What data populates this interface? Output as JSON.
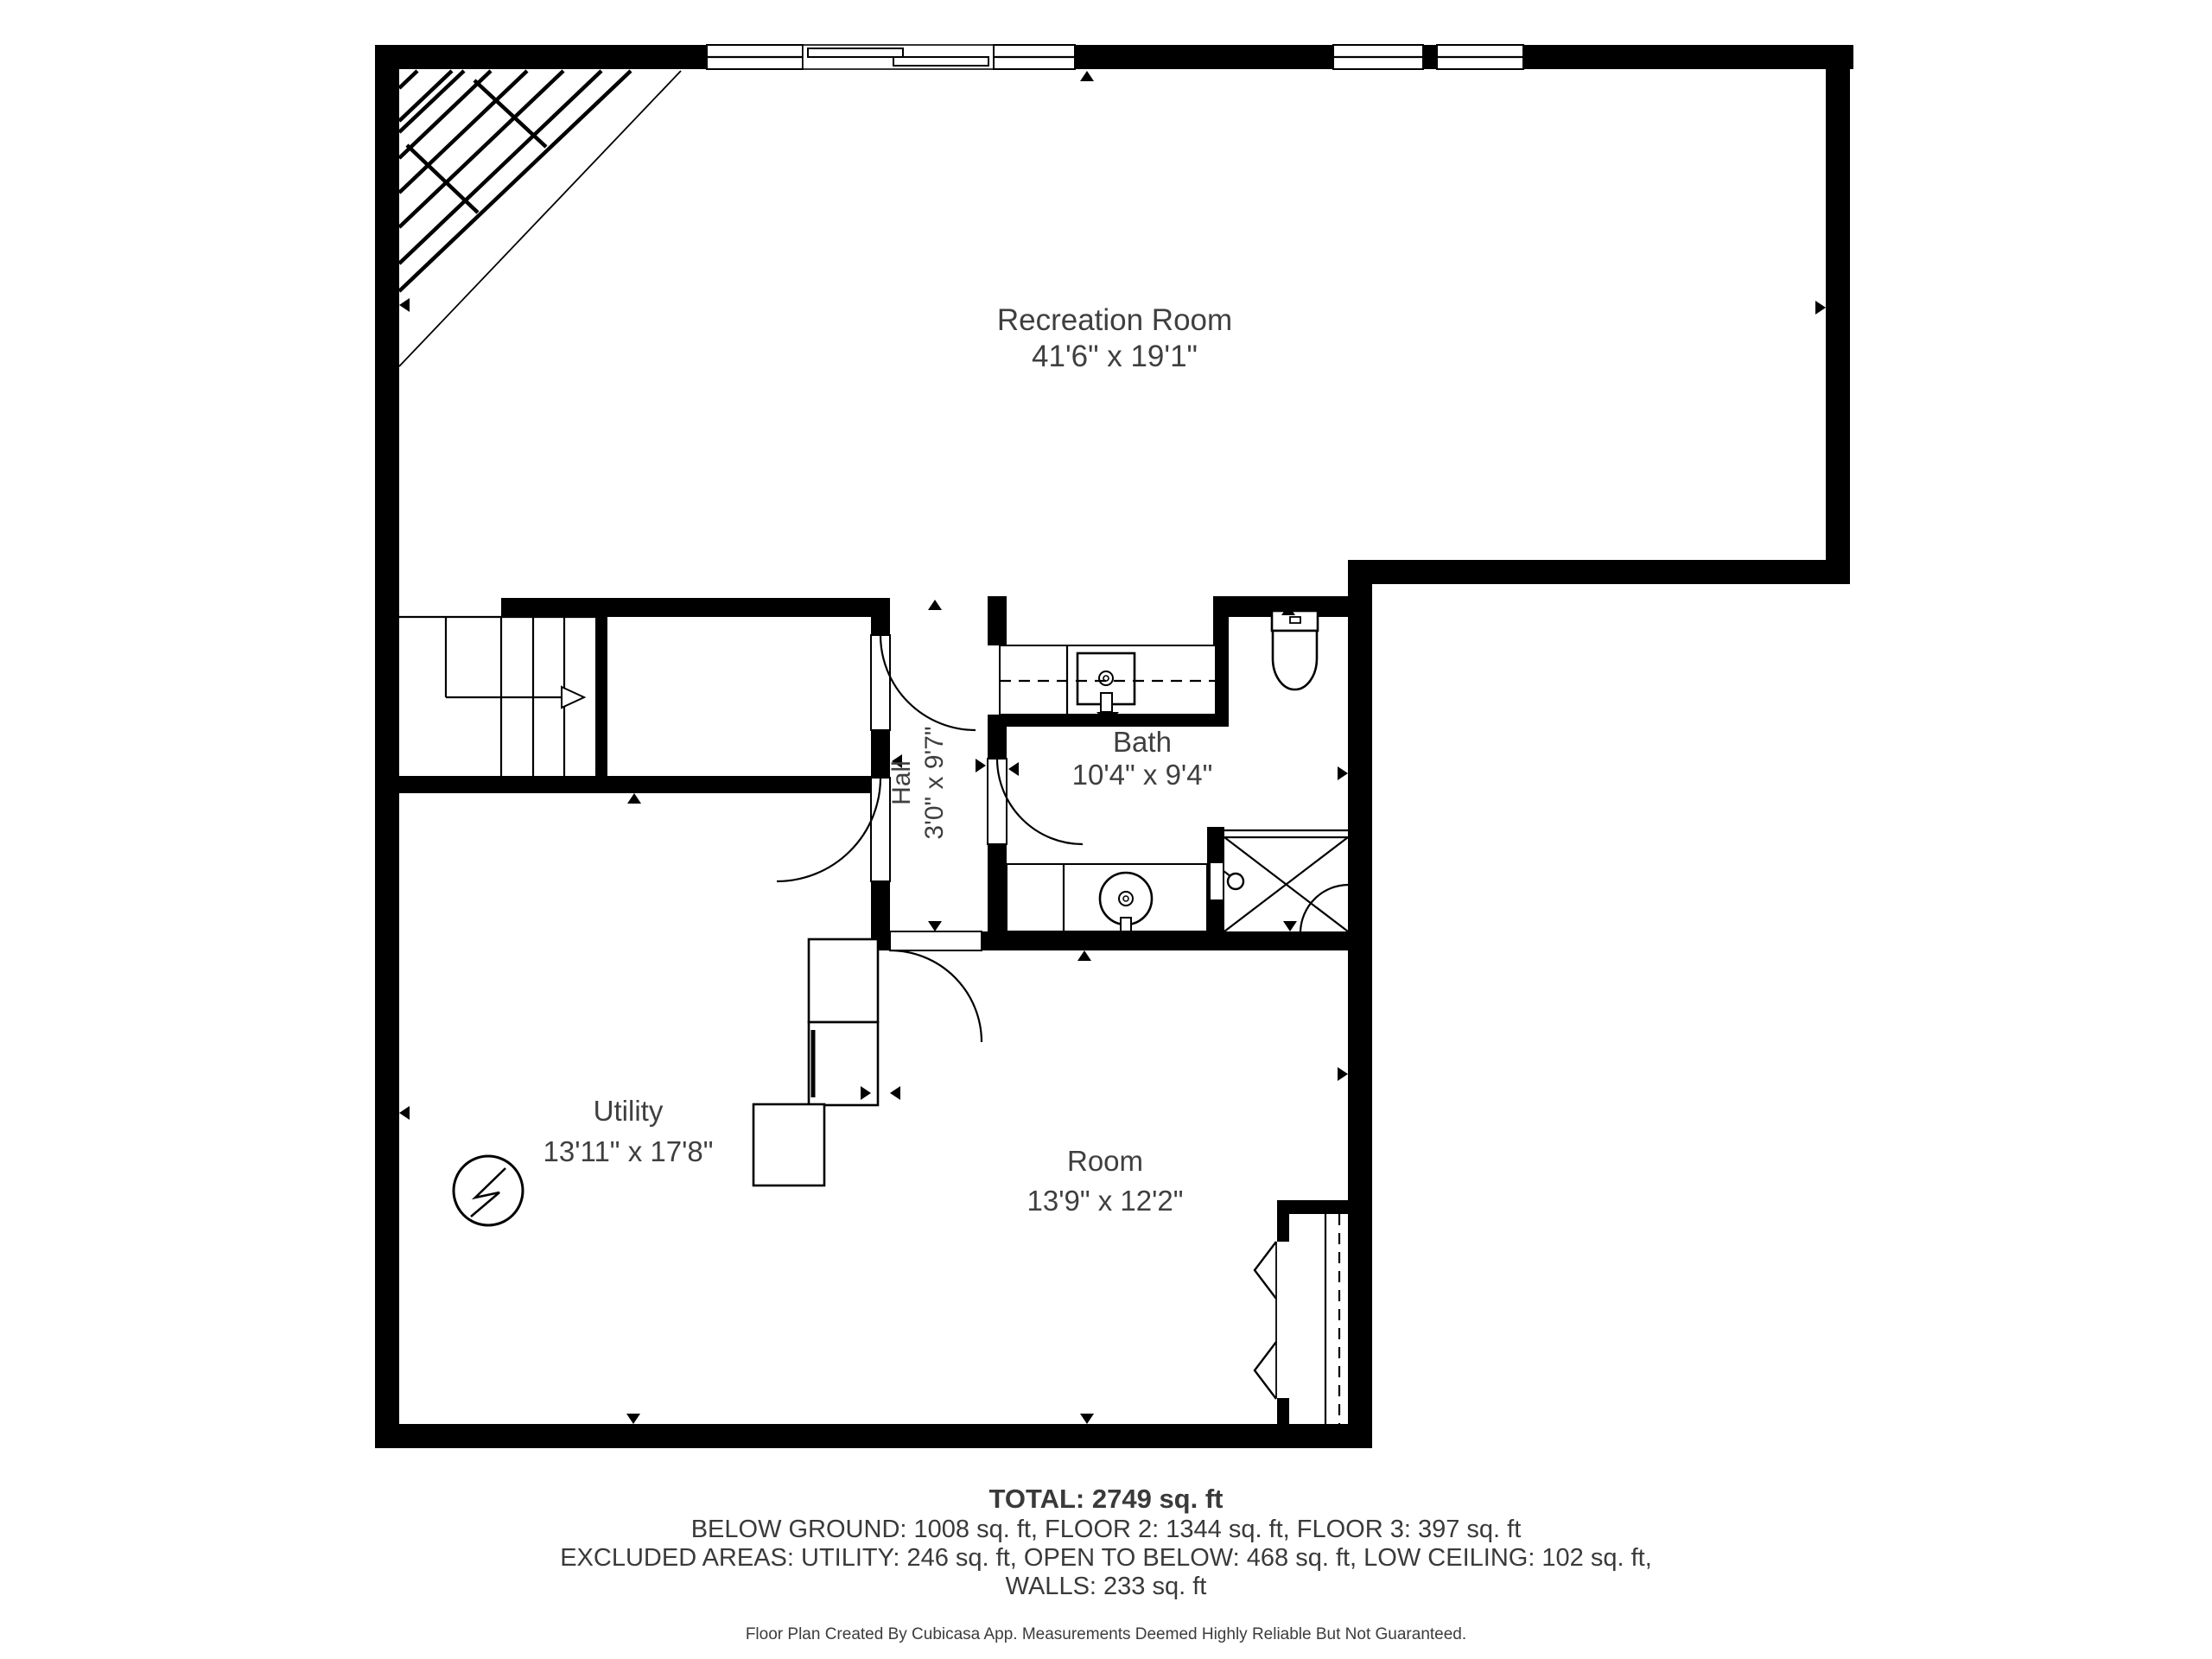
{
  "rooms": {
    "recreation": {
      "name": "Recreation Room",
      "dims": "41'6\" x 19'1\""
    },
    "hall": {
      "name": "Hall",
      "dims": "3'0\" x 9'7\""
    },
    "bath": {
      "name": "Bath",
      "dims": "10'4\" x 9'4\""
    },
    "utility": {
      "name": "Utility",
      "dims": "13'11\" x 17'8\""
    },
    "room": {
      "name": "Room",
      "dims": "13'9\" x 12'2\""
    }
  },
  "summary": {
    "total": "TOTAL: 2749 sq. ft",
    "floors": "BELOW GROUND: 1008 sq. ft, FLOOR 2: 1344 sq. ft, FLOOR 3: 397 sq. ft",
    "excluded": "EXCLUDED AREAS: UTILITY: 246 sq. ft, OPEN TO BELOW: 468 sq. ft, LOW CEILING: 102 sq. ft,",
    "walls": "WALLS: 233 sq. ft",
    "disclaimer": "Floor Plan Created By Cubicasa App. Measurements Deemed Highly Reliable But Not Guaranteed."
  },
  "colors": {
    "wall": "#000000",
    "label": "#3f3f3f",
    "background": "#ffffff"
  }
}
